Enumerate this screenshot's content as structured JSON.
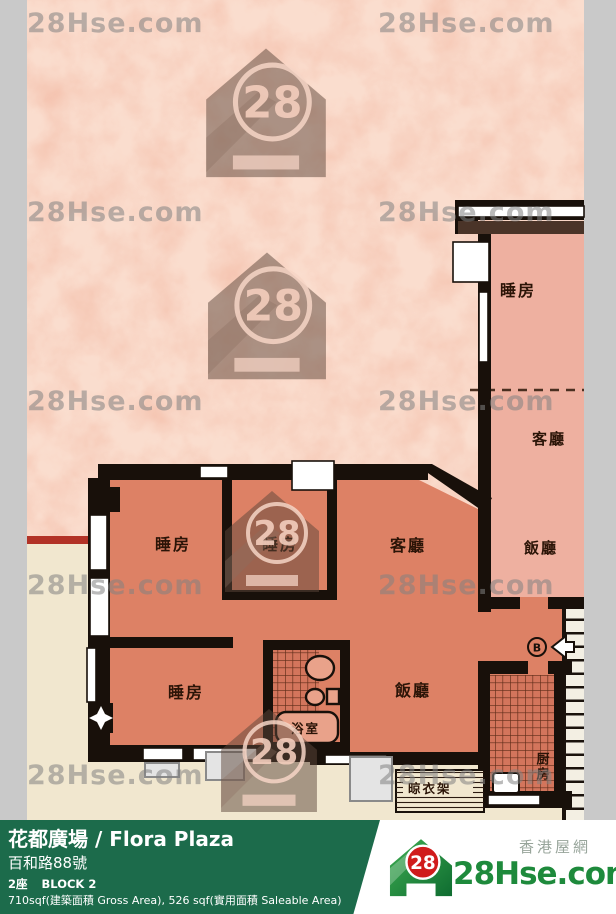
{
  "watermark": {
    "text": "28Hse.com",
    "logo_number": "28"
  },
  "floor_plan": {
    "labels": {
      "adjacent_bedroom": "睡房",
      "adjacent_living": "客廳",
      "adjacent_dining": "飯廳",
      "bedroom_1": "睡房",
      "bedroom_2": "睡房",
      "living_room": "客廳",
      "bedroom_3": "睡房",
      "dining_room": "飯廳",
      "bathroom": "浴室",
      "kitchen": "厨房",
      "drying_rack": "晾衣架",
      "entrance_marker": "B"
    }
  },
  "footer": {
    "title": "花都廣場 / Flora Plaza",
    "address": "百和路88號",
    "block_cn": "2座",
    "block_en": "BLOCK 2",
    "area": "710sqf(建築面積 Gross Area), 526 sqf(實用面積 Saleable Area)",
    "brand": {
      "logo_number": "28",
      "site_name": "28Hse.com",
      "site_name_cn": "香港屋網"
    }
  },
  "colors": {
    "accent_green": "#1c6b4b",
    "brand_green": "#1e8a3c",
    "badge_red": "#d01c1c",
    "unit_fill": "#dd8165",
    "adjacent_unit_fill": "#eeb0a0",
    "background_pink": "#f2b7a1",
    "outside_cream": "#f1e7cf",
    "wall": "#18100a",
    "highlight_red": "#b23226",
    "frame_gray": "#c9c9c9"
  }
}
